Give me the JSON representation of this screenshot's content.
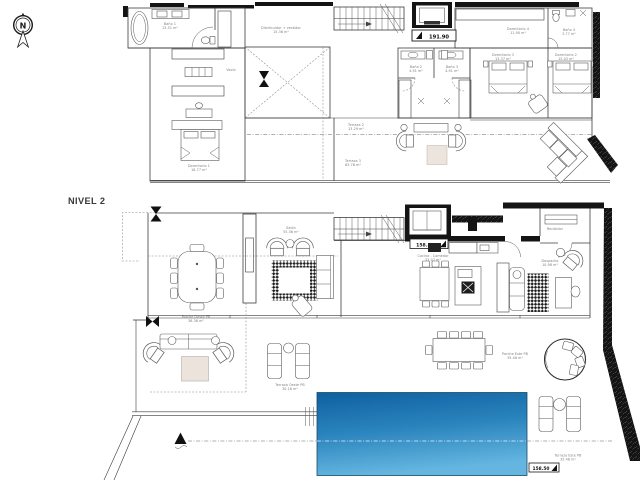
{
  "title": {
    "level_label": "NIVEL 2"
  },
  "compass": {
    "north_letter": "N"
  },
  "level_markers": {
    "upper": "191.90",
    "main_top": "158.50",
    "main_bottom": "158.50"
  },
  "upper_floor": {
    "rooms": {
      "bano1": {
        "name": "Baño 1",
        "area": "13.51 m²"
      },
      "distribuidor": {
        "name": "Distribuidor + vestidor",
        "area": "15.36 m²"
      },
      "vacio": {
        "name": "Vacío"
      },
      "dormitorio1": {
        "name": "Dormitorio 1",
        "area": "18.77 m²"
      },
      "dormitorio4": {
        "name": "Dormitorio 4",
        "area": "11.90 m²"
      },
      "bano4": {
        "name": "Baño 4",
        "area": "3.77 m²"
      },
      "bano2": {
        "name": "Baño 2",
        "area": "4.91 m²"
      },
      "bano3": {
        "name": "Baño 3",
        "area": "4.91 m²"
      },
      "dormitorio3": {
        "name": "Dormitorio 3",
        "area": "13.37 m²"
      },
      "dormitorio2": {
        "name": "Dormitorio 2",
        "area": "15.03 m²"
      },
      "terraza2": {
        "name": "Terraza 2",
        "area": "13.29 m²"
      },
      "terraza3": {
        "name": "Terraza 3",
        "area": "63.76 m²"
      }
    }
  },
  "main_floor": {
    "rooms": {
      "salon": {
        "name": "Salón",
        "area": "55.36 m²"
      },
      "cocina": {
        "name": "Cocina - Comedor",
        "area": "33.07 m²"
      },
      "despacho": {
        "name": "Despacho",
        "area": "10.98 m²"
      },
      "recibidor": {
        "name": "Recibidor"
      },
      "porche_oeste": {
        "name": "Porche Oeste PB",
        "area": "36.36 m²"
      },
      "terraza_oeste": {
        "name": "Terraza Oeste PB",
        "area": "30.16 m²"
      },
      "porche_este": {
        "name": "Porche Este PB",
        "area": "35.46 m²"
      },
      "terraza_este": {
        "name": "Terraza Este PB",
        "area": "35.46 m²"
      }
    }
  },
  "colors": {
    "pool_top": "#0e60a0",
    "pool_mid": "#2b84bd",
    "pool_bottom": "#64b6e0",
    "wall_dark": "#141414",
    "linework": "#3d3d3d",
    "label": "#7c7c7c",
    "table_fill": "#ece4dc"
  }
}
